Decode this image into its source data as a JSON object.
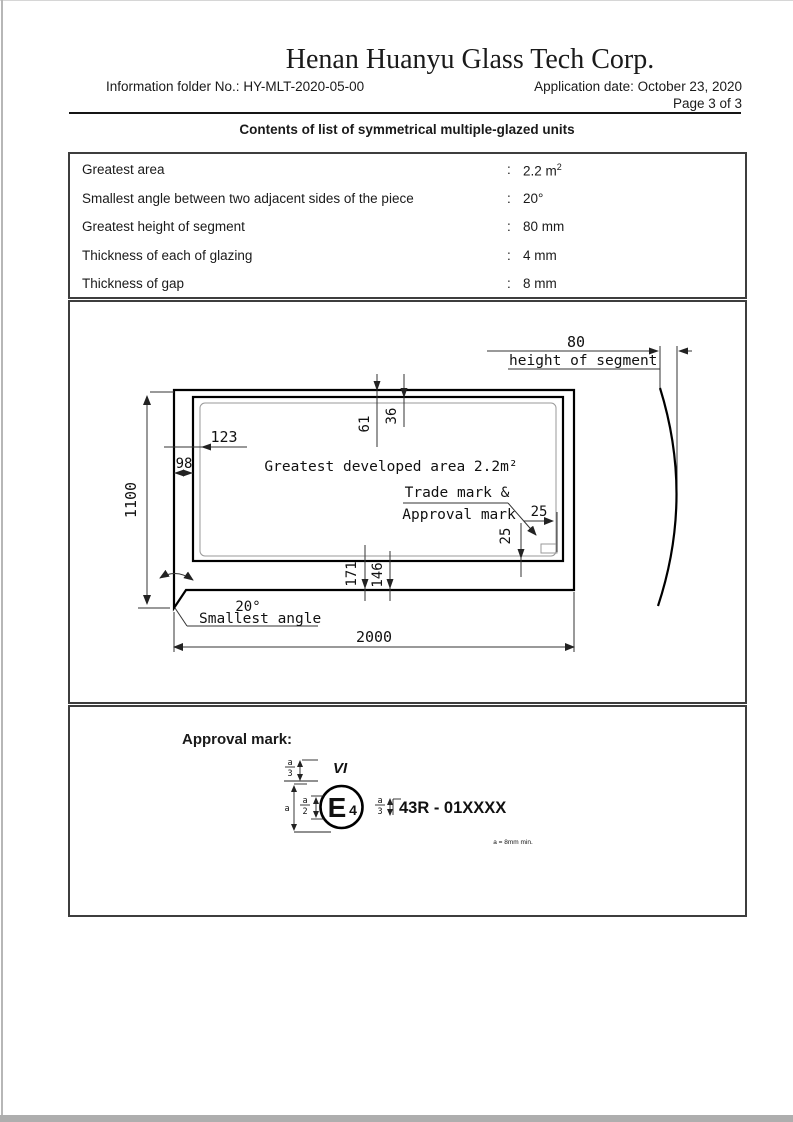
{
  "header": {
    "company": "Henan Huanyu Glass Tech Corp.",
    "info_folder": "Information folder No.: HY-MLT-2020-05-00",
    "application_date": "Application date: October 23, 2020",
    "page": "Page 3 of 3",
    "title": "Contents of list of symmetrical multiple-glazed units"
  },
  "spec_table": {
    "colon": ":",
    "rows": [
      {
        "label": "Greatest area",
        "value": "2.2 m",
        "sup": "2"
      },
      {
        "label": "Smallest angle between two adjacent sides of the piece",
        "value": "20°",
        "sup": ""
      },
      {
        "label": "Greatest height of segment",
        "value": "80 mm",
        "sup": ""
      },
      {
        "label": "Thickness of each of glazing",
        "value": "4 mm",
        "sup": ""
      },
      {
        "label": "Thickness of gap",
        "value": "8 mm",
        "sup": ""
      }
    ]
  },
  "drawing": {
    "dim_80": "80",
    "height_of_segment": "height of segment",
    "dim_1100": "1100",
    "dim_123": "123",
    "dim_98": "98",
    "dim_61": "61",
    "dim_36": "36",
    "dim_171": "171",
    "dim_146": "146",
    "dim_25_horizontal": "25",
    "dim_25_vertical": "25",
    "dim_2000": "2000",
    "area_label": "Greatest developed area 2.2m²",
    "trademark_label_line1": "Trade mark &",
    "trademark_label_line2": "Approval mark",
    "angle_value": "20°",
    "angle_label": "Smallest angle"
  },
  "approval": {
    "heading": "Approval mark:",
    "vi_label": "VI",
    "circle_letter": "E",
    "circle_number": "4",
    "code": "43R - 01XXXX",
    "note": "a = 8mm min.",
    "dim_a": "a",
    "frac_a": "a",
    "frac_2": "2",
    "frac_3": "3"
  }
}
